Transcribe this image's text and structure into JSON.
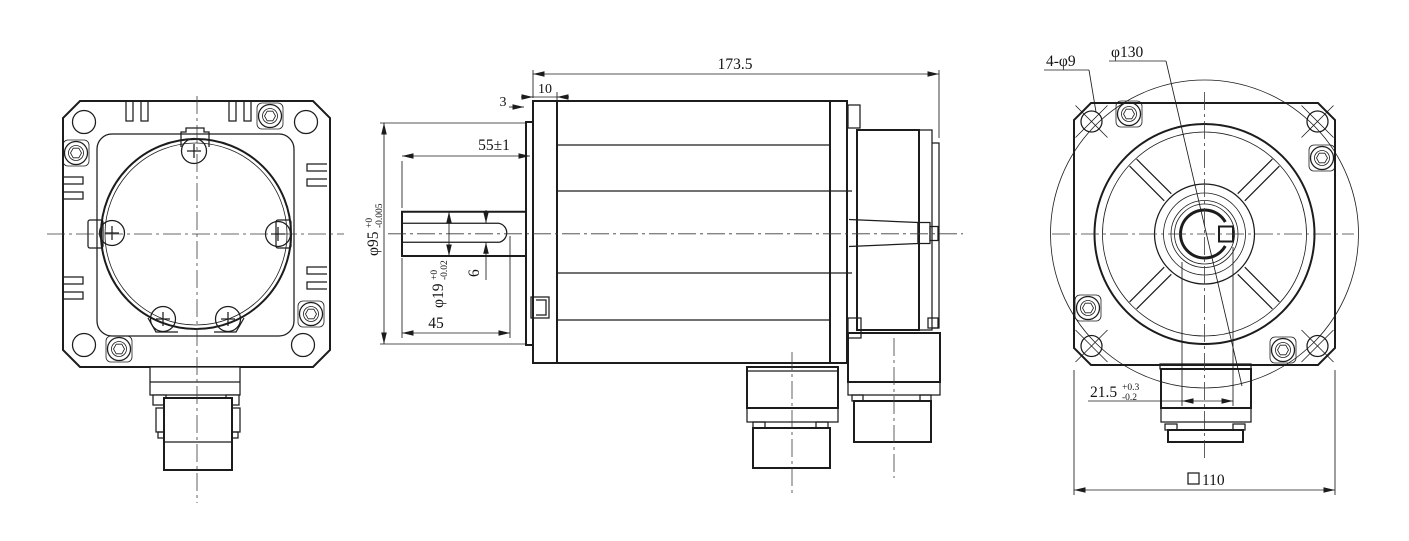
{
  "drawing": {
    "description": "Servo motor outline dimensional drawing, three orthographic views",
    "background": "#ffffff",
    "line_color": "#1c1c1c",
    "views": {
      "rear": "rear view with square finned flange, cover circle and connector",
      "side": "side view with shaft, keyway, motor body, encoder housing and two connectors",
      "front": "front flange view with pilot, ribs, shaft keyway and connector"
    },
    "dims": {
      "overall_length": "173.5",
      "flange_thickness": "10",
      "spigot_step": "3",
      "shaft_length": "55±1",
      "spigot_dia": "φ95",
      "spigot_tol_upper": "+0",
      "spigot_tol_lower": "-0.005",
      "shaft_dia": "φ19",
      "shaft_tol_upper": "+0",
      "shaft_tol_lower": "-0.02",
      "key_width": "6",
      "key_length": "45",
      "mounting_holes": "4-φ9",
      "bolt_circle": "φ130",
      "key_height": "21.5",
      "key_height_tol_upper": "+0.3",
      "key_height_tol_lower": "-0.2",
      "flange_size_symbol": "□",
      "flange_size": "110"
    }
  }
}
